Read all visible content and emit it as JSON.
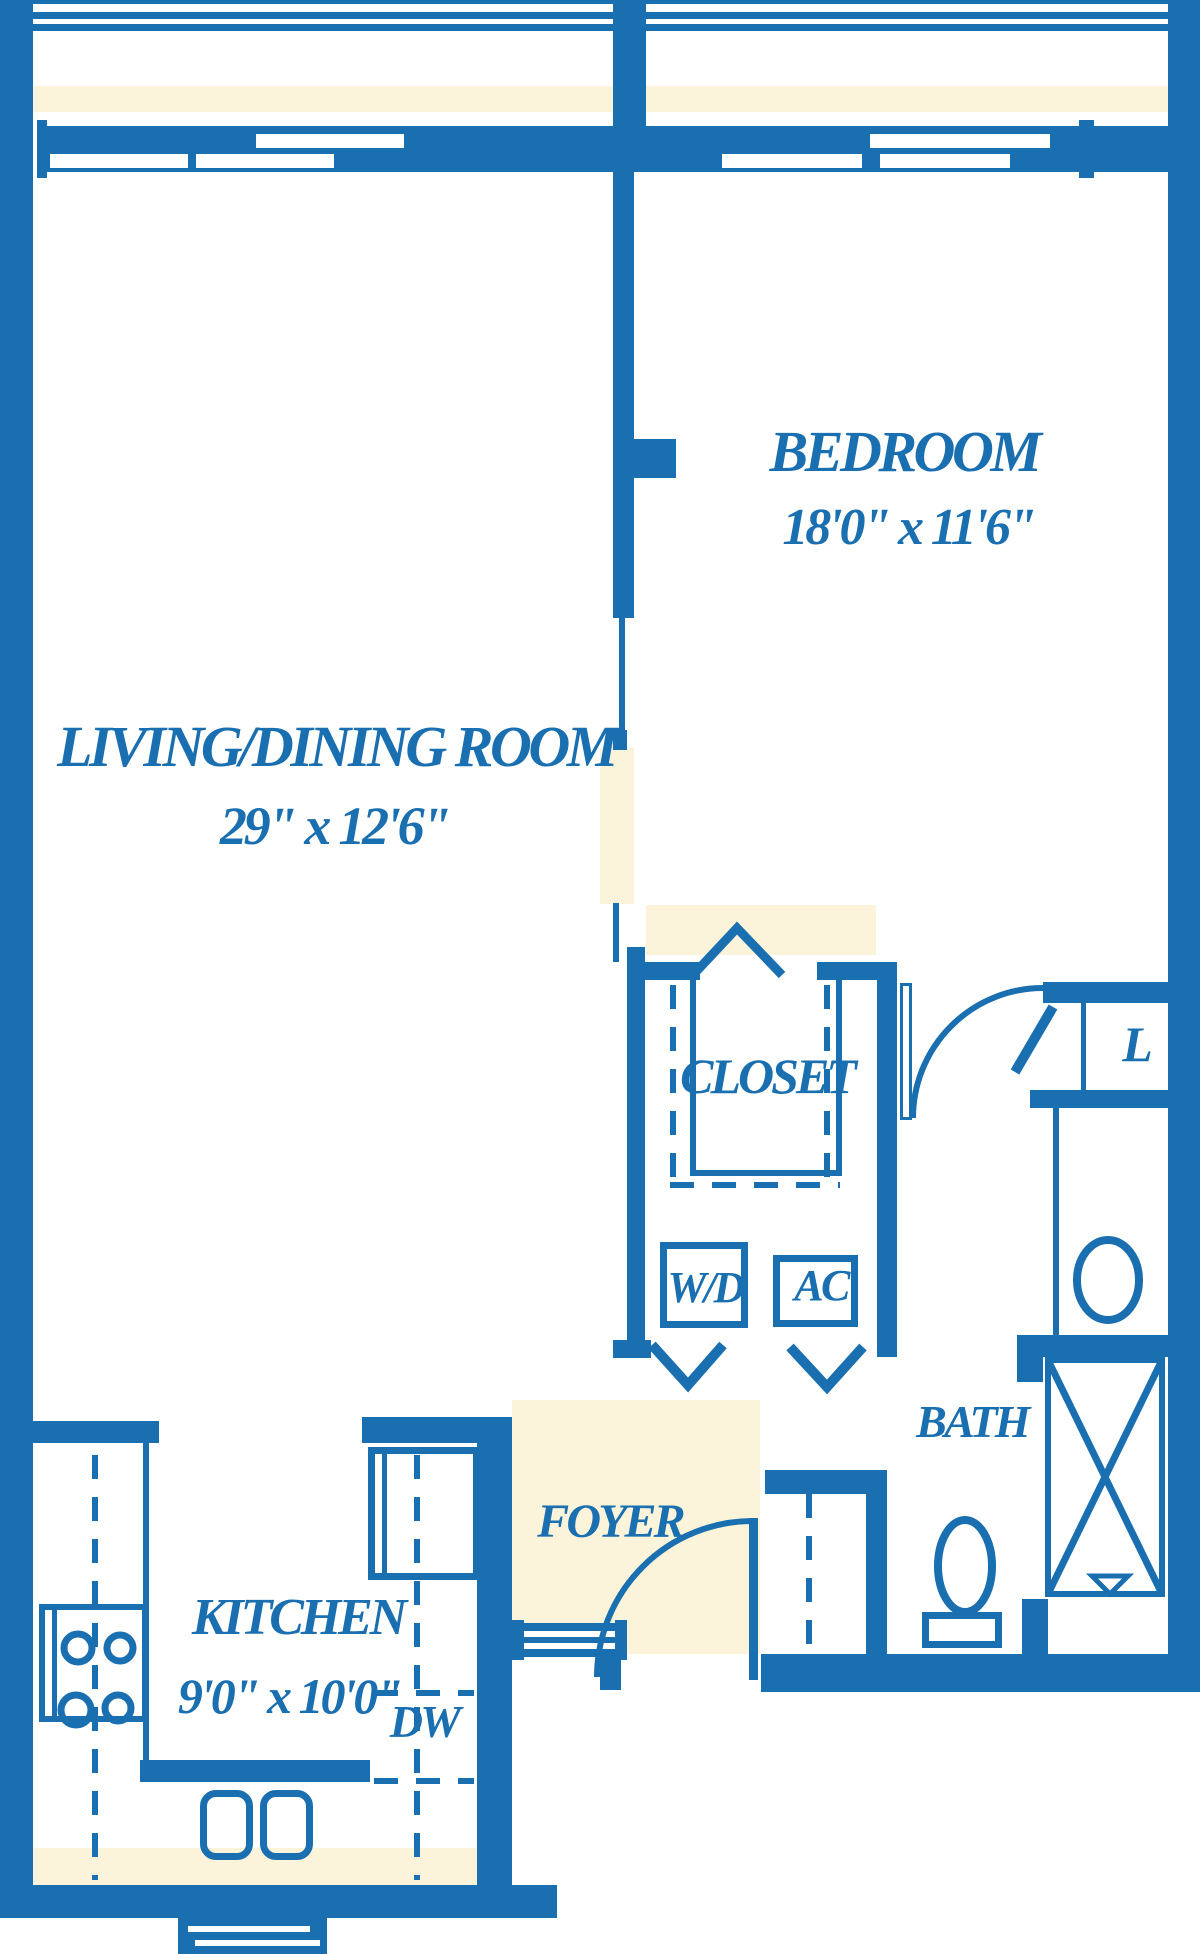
{
  "colors": {
    "ink": "#1a6fb0",
    "paper": "#ffffff",
    "tint": "#fbf4da"
  },
  "rooms": {
    "living": {
      "name": "LIVING/DINING ROOM",
      "dims": "29\" x 12'6\""
    },
    "bedroom": {
      "name": "BEDROOM",
      "dims": "18'0\" x 11'6\""
    },
    "kitchen": {
      "name": "KITCHEN",
      "dims": "9'0\" x 10'0\""
    },
    "closet": {
      "name": "CLOSET"
    },
    "bath": {
      "name": "BATH"
    },
    "foyer": {
      "name": "FOYER"
    },
    "linen": {
      "name": "L"
    },
    "washer_dryer": {
      "name": "W/D"
    },
    "ac": {
      "name": "AC"
    },
    "dishwasher": {
      "name": "DW"
    }
  }
}
